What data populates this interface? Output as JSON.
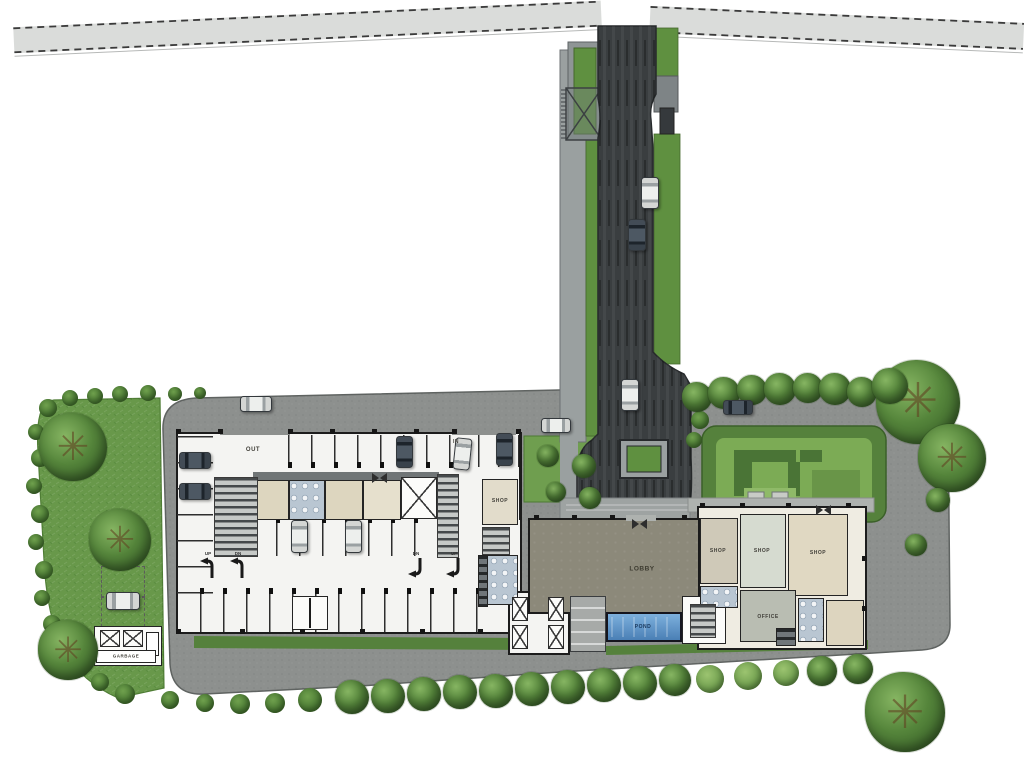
{
  "plan": {
    "type": "architectural-site-plan",
    "labels": {
      "out": "OUT",
      "in": "IN",
      "shop": "SHOP",
      "lobby": "LOBBY",
      "pond": "POND",
      "office": "OFFICE",
      "garbage": "GARBAGE"
    },
    "ramp_arrows": [
      {
        "label": "UP"
      },
      {
        "label": "DN"
      },
      {
        "label": "DN"
      },
      {
        "label": "UP"
      }
    ],
    "colors": {
      "road": "#d9dbd9",
      "driveway_asphalt": "#3a3e40",
      "site_asphalt": "#8d908e",
      "grass": "#68984a",
      "tree_green": "#3e6c2f",
      "building_floor": "#f4f4f2",
      "room_beige": "#ddd6bf",
      "lobby_floor": "#8c897a",
      "pond_blue": "#5d8fc4",
      "restroom_blue": "#b9c6d2",
      "wall": "#1c1c1c"
    }
  }
}
